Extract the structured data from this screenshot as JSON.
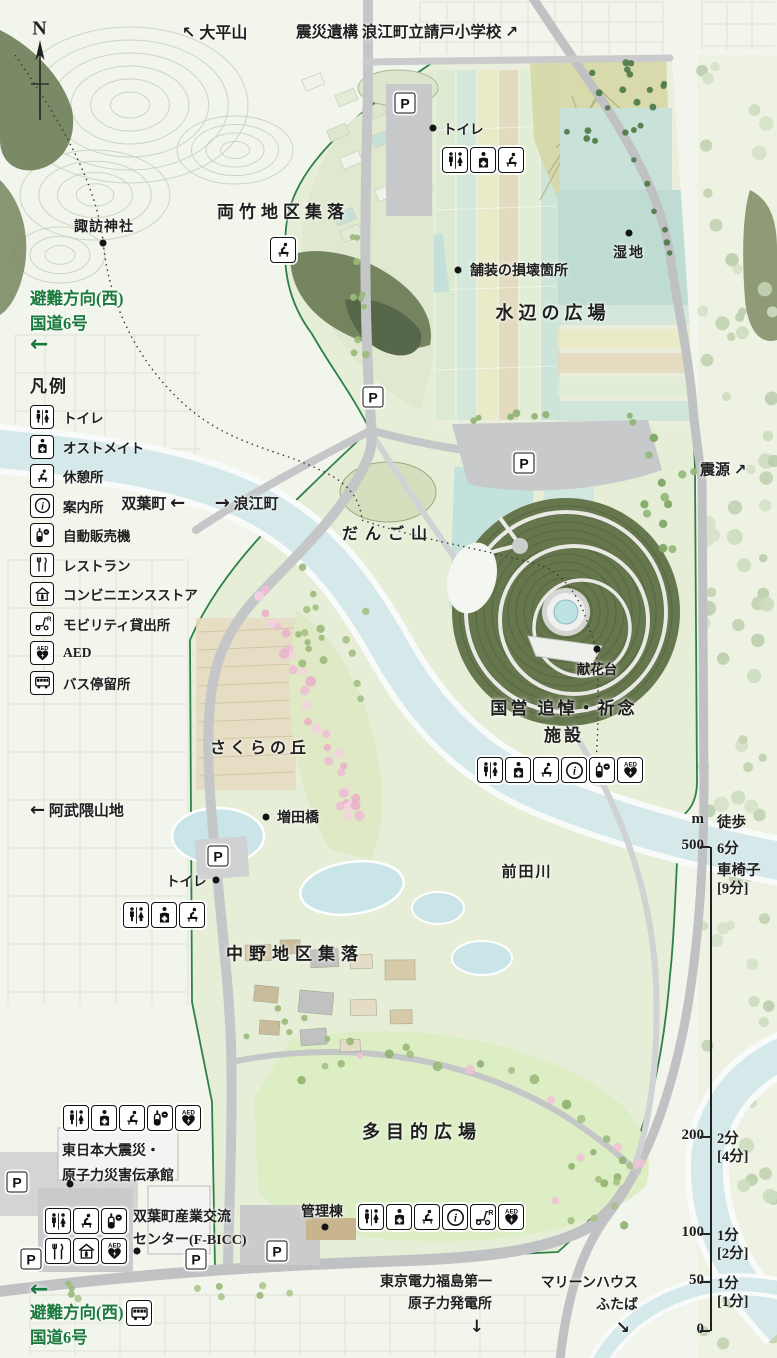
{
  "colors": {
    "park_outline": "#2f8048",
    "water": "#d5e8ea",
    "spiral_green": "#66764d",
    "road_gray": "#c4c6c8",
    "evac_green": "#1a7a3e",
    "sakura_pink": "#edbfd2",
    "text": "#1f1f1f"
  },
  "compass": {
    "label": "N"
  },
  "top_labels": {
    "ohirayama": {
      "arrow": "↖",
      "text": "大平山"
    },
    "ukedo_school": {
      "text": "震災遺構 浪江町立請戸小学校",
      "arrow": "↗"
    }
  },
  "evacuation_top": {
    "line1": "避難方向(西)",
    "line2": "国道6号",
    "arrow": "←"
  },
  "evacuation_bottom": {
    "line1": "避難方向(西)",
    "line2": "国道6号",
    "arrow": "←"
  },
  "legend": {
    "title": "凡例",
    "items": [
      {
        "icon": "toilet",
        "label": "トイレ"
      },
      {
        "icon": "ostomate",
        "label": "オストメイト"
      },
      {
        "icon": "rest",
        "label": "休憩所"
      },
      {
        "icon": "info",
        "label": "案内所"
      },
      {
        "icon": "vending",
        "label": "自動販売機"
      },
      {
        "icon": "restaurant",
        "label": "レストラン"
      },
      {
        "icon": "convenience",
        "label": "コンビニエンスストア"
      },
      {
        "icon": "mobility",
        "label": "モビリティ貸出所"
      },
      {
        "icon": "aed",
        "label": "AED"
      },
      {
        "icon": "bus",
        "label": "バス停留所"
      }
    ]
  },
  "places": {
    "suwa_shrine": "諏訪神社",
    "ryotake": "両竹地区集落",
    "mizube": "水辺の広場",
    "wetland": "湿地",
    "pavement_damage": "舗装の損壊箇所",
    "toilet_top": "トイレ",
    "toilet_sakura": "トイレ",
    "dango": "だんご山",
    "sakura_hill": "さくらの丘",
    "masuda_bridge": "増田橋",
    "nakano": "中野地区集落",
    "maeda_river": "前田川",
    "memorial_line1": "国営 追悼・祈念",
    "memorial_line2": "施設",
    "kenkadai": "献花台",
    "tamokuteki": "多目的広場",
    "denshokan_line1": "東日本大震災・",
    "denshokan_line2": "原子力災害伝承館",
    "fbicc_line1": "双葉町産業交流",
    "fbicc_line2": "センター(F-BICC)",
    "kanritou": "管理棟"
  },
  "directions": {
    "futaba": "双葉町",
    "futaba_arrow": "←",
    "namie_arrow": "→",
    "namie": "浪江町",
    "epicenter": "震源",
    "epicenter_arrow": "↗",
    "abukuma_arrow": "←",
    "abukuma": "阿武隈山地",
    "tepco_line1": "東京電力福島第一",
    "tepco_line2": "原子力発電所",
    "tepco_arrow": "↓",
    "marine_line1": "マリーンハウス",
    "marine_line2": "ふたば",
    "marine_arrow": "↘"
  },
  "markers": {
    "parking": "P"
  },
  "scale_bar": {
    "unit": "m",
    "walk_header": "徒歩",
    "wheelchair_label": "車椅子",
    "rows": [
      {
        "m": "500",
        "walk": "6分",
        "wheel": "[9分]"
      },
      {
        "m": "200",
        "walk": "2分",
        "wheel": "[4分]"
      },
      {
        "m": "100",
        "walk": "1分",
        "wheel": "[2分]"
      },
      {
        "m": "50",
        "walk": "1分",
        "wheel": "[1分]"
      },
      {
        "m": "0",
        "walk": "",
        "wheel": ""
      }
    ]
  },
  "icon_groups": {
    "water_plaza": [
      "toilet",
      "ostomate",
      "rest"
    ],
    "ryotake_rest": [
      "rest"
    ],
    "memorial": [
      "toilet",
      "ostomate",
      "rest",
      "info",
      "vending",
      "aed"
    ],
    "sakura": [
      "toilet",
      "ostomate",
      "rest"
    ],
    "denshokan": [
      "toilet",
      "ostomate",
      "rest",
      "vending",
      "aed"
    ],
    "fbicc_row1": [
      "toilet",
      "rest",
      "vending"
    ],
    "fbicc_row2": [
      "restaurant",
      "convenience",
      "aed"
    ],
    "kanritou": [
      "toilet",
      "ostomate",
      "rest",
      "info",
      "mobility",
      "aed"
    ],
    "bus_stop": [
      "bus"
    ]
  }
}
